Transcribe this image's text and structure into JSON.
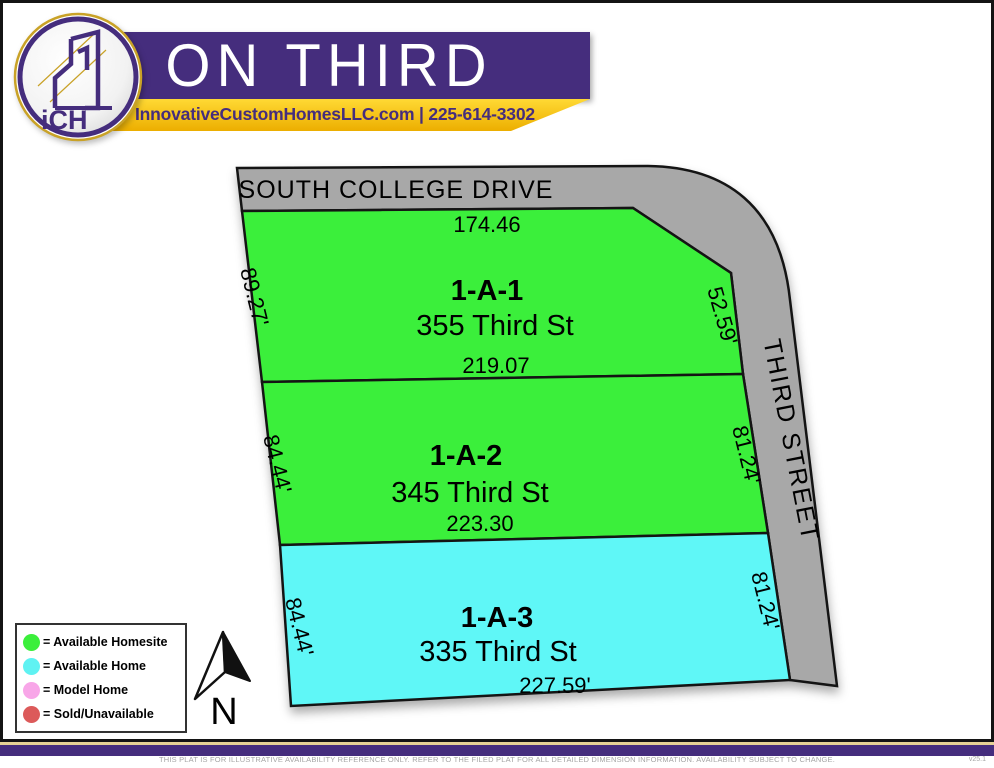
{
  "header": {
    "logo_text": "iCH",
    "title": "ON THIRD",
    "contact": "InnovativeCustomHomesLLC.com | 225-614-3302"
  },
  "map": {
    "roads": {
      "top": "SOUTH COLLEGE DRIVE",
      "right": "THIRD STREET"
    },
    "lots": [
      {
        "id": "1-A-1",
        "address": "355 Third St",
        "status": "available_homesite",
        "dim_top": "174.46",
        "dim_bottom": "219.07",
        "dim_left": "89.27'",
        "dim_right": "52.59'"
      },
      {
        "id": "1-A-2",
        "address": "345 Third St",
        "status": "available_homesite",
        "dim_bottom": "223.30",
        "dim_left": "84.44'",
        "dim_right": "81.24'"
      },
      {
        "id": "1-A-3",
        "address": "335 Third St",
        "status": "available_home",
        "dim_bottom": "227.59'",
        "dim_left": "84.44'",
        "dim_right": "81.24'"
      }
    ],
    "compass": {
      "label": "N"
    }
  },
  "legend": {
    "items": [
      {
        "label": "= Available Homesite",
        "color": "#3bef3b"
      },
      {
        "label": "= Available Home",
        "color": "#5ff2f2"
      },
      {
        "label": "= Model Home",
        "color": "#f8a6e8"
      },
      {
        "label": "= Sold/Unavailable",
        "color": "#dc5a5a"
      }
    ]
  },
  "footer": {
    "disclaimer": "THIS PLAT IS FOR ILLUSTRATIVE AVAILABILITY REFERENCE ONLY. REFER TO THE FILED PLAT FOR ALL DETAILED DIMENSION INFORMATION. AVAILABILITY SUBJECT TO CHANGE.",
    "version": "v25.1"
  },
  "colors": {
    "available_homesite": "#3bef3b",
    "available_home": "#5ff7f7",
    "road": "#a8a8a8",
    "purple": "#452d7d",
    "gold": "#f2b705",
    "line": "#141414"
  }
}
